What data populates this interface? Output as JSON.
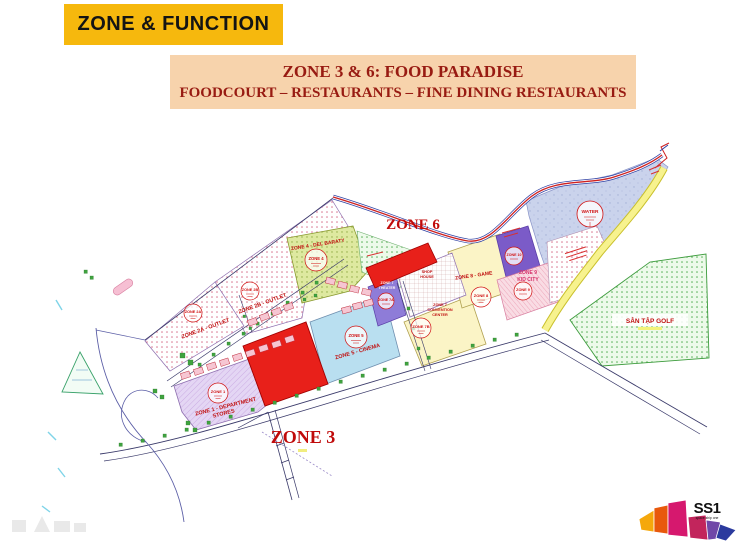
{
  "slide": {
    "banner": "ZONE & FUNCTION"
  },
  "title_box": {
    "line1": "ZONE 3 & 6: FOOD PARADISE",
    "line2": "FOODCOURT – RESTAURANTS – FINE DINING RESTAURANTS"
  },
  "map": {
    "zone6": "ZONE 6",
    "zone3": "ZONE 3",
    "labels": {
      "zone2a": "ZONE 2A - OUTLET",
      "zone2b": "ZONE 2B - OUTLET",
      "zone1_l1": "ZONE 1 - DEPARTMENT",
      "zone1_l2": "STORES",
      "zone4": "ZONE 4 - DEL BARATY",
      "zone5": "ZONE 5 - CINEMA",
      "theater_l1": "ZONE 7",
      "theater_l2": "THEATER",
      "shophouse_l1": "SHOP",
      "shophouse_l2": "HOUSE",
      "cc_l1": "ZONE 7",
      "cc_l2": "CONVENTION",
      "cc_l3": "CENTER",
      "zone8": "ZONE 8 - GAME",
      "zone9_l1": "ZONE 9",
      "zone9_l2": "KID CITY",
      "golf": "SÂN TẬP GOLF"
    },
    "stamps": {
      "zone1": "ZONE 1",
      "zone2a": "ZONE 2A",
      "zone2b": "ZONE 2B",
      "zone4": "ZONE 4",
      "zone5": "ZONE 5",
      "zone7a": "ZONE 7A",
      "zone7b": "ZONE 7B",
      "zone8": "ZONE 8",
      "zone9": "ZONE 9",
      "zone10": "ZONE 10",
      "water": "WATER"
    }
  },
  "logo": {
    "name": "SS1",
    "tagline": "space ship one"
  },
  "colors": {
    "banner_bg": "#F6B80D",
    "title_bg": "#F7D3AC",
    "heading_red": "#981B12",
    "map_label_red": "#C01010",
    "parcel_red": "#E8201A",
    "water_blue": "#CAD3EC",
    "golf_green": "#E7F7E3",
    "zone_purple": "#7B5BC8",
    "road_yellow": "#F7F28E"
  }
}
